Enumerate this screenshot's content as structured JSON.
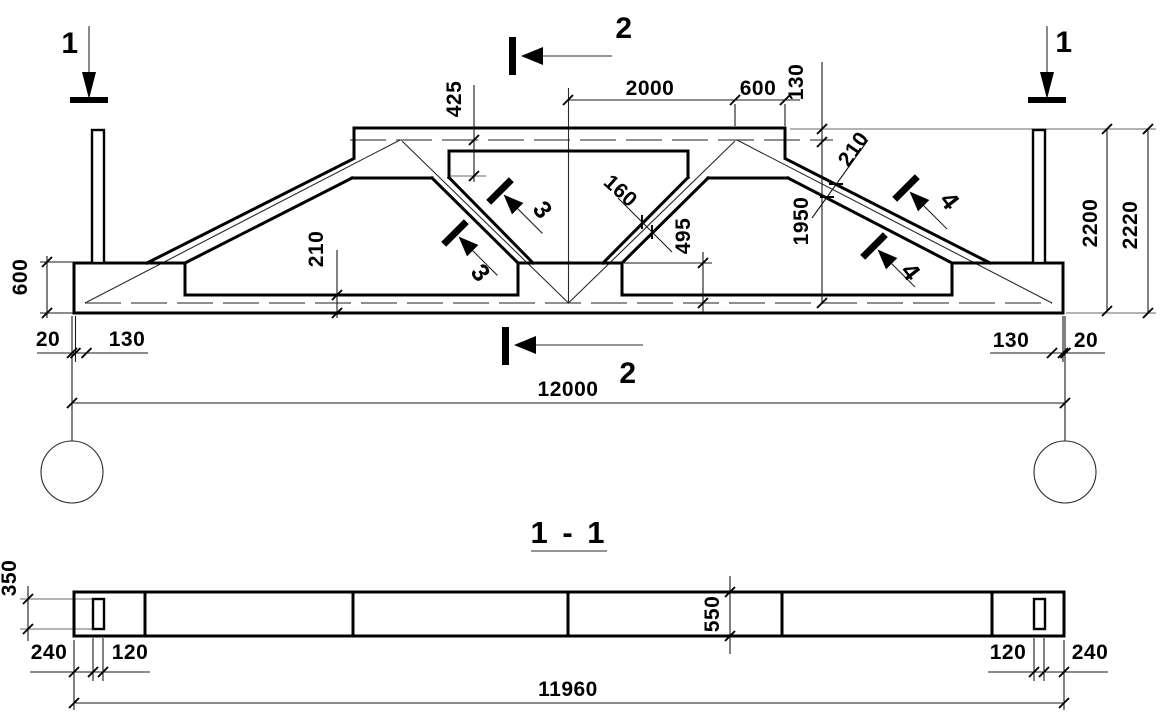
{
  "drawing": {
    "background": "#ffffff",
    "line_color": "#000000",
    "axis_color": "#8f8f8f",
    "elevation": {
      "section_markers": {
        "m1_left": "1",
        "m1_right": "1",
        "m2_top": "2",
        "m2_bottom": "2",
        "m3_upper": "3",
        "m3_lower": "3",
        "m4_upper": "4",
        "m4_lower": "4"
      },
      "dimensions": {
        "top_center_halfwidth": "2000",
        "top_right_segment": "600",
        "top_edge_to_axis": "130",
        "axis_to_haunch": "425",
        "axis_height": "1950",
        "node_height": "495",
        "end_block_height": "600",
        "bottom_chord_thickness": "210",
        "web_thickness": "160",
        "top_chord_thickness": "210",
        "bearing_left_offset": "20",
        "bearing_left_inset": "130",
        "bearing_right_inset": "130",
        "bearing_right_offset": "20",
        "span": "12000",
        "height_to_chord": "2200",
        "total_height": "2220"
      }
    },
    "section_1_1": {
      "title": "1 - 1",
      "dimensions": {
        "end_width": "350",
        "end_to_socket": "240",
        "socket_width_left": "120",
        "beam_width": "550",
        "socket_width_right": "120",
        "socket_to_end": "240",
        "length": "11960"
      }
    }
  }
}
